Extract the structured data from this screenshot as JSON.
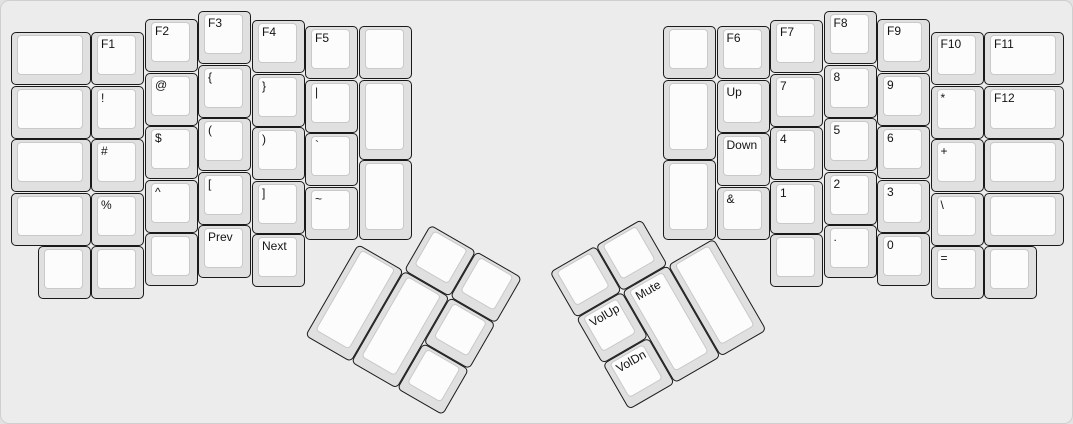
{
  "style": {
    "canvas_bg": "#ececec",
    "canvas_border": "#cfcfcf",
    "cap_color": "#e0e0e0",
    "cap_border": "#1a1a1a",
    "face_color": "#fcfcfc",
    "face_border": "#c9c9c9",
    "label_color": "#141414"
  },
  "left_main": {
    "name": "left-hand-block",
    "rotation_deg": 0,
    "origin_x": 0,
    "origin_y": 0,
    "keys": [
      {
        "label": "",
        "name": "blank",
        "x": 10,
        "y": 31,
        "w": 80,
        "h": 53
      },
      {
        "label": "F1",
        "name": "f1",
        "x": 90,
        "y": 31,
        "w": 53,
        "h": 53
      },
      {
        "label": "F2",
        "name": "f2",
        "x": 144,
        "y": 18,
        "w": 53,
        "h": 53
      },
      {
        "label": "F3",
        "name": "f3",
        "x": 197,
        "y": 10,
        "w": 53,
        "h": 53
      },
      {
        "label": "F4",
        "name": "f4",
        "x": 251,
        "y": 19,
        "w": 53,
        "h": 53
      },
      {
        "label": "F5",
        "name": "f5",
        "x": 304,
        "y": 25,
        "w": 53,
        "h": 53
      },
      {
        "label": "",
        "name": "blank",
        "x": 358,
        "y": 25,
        "w": 53,
        "h": 53
      },
      {
        "label": "",
        "name": "blank",
        "x": 10,
        "y": 84.5,
        "w": 80,
        "h": 53
      },
      {
        "label": "!",
        "name": "exclamation",
        "x": 90,
        "y": 84.5,
        "w": 53,
        "h": 53
      },
      {
        "label": "@",
        "name": "at",
        "x": 144,
        "y": 71.5,
        "w": 53,
        "h": 53
      },
      {
        "label": "{",
        "name": "left-brace",
        "x": 197,
        "y": 63.5,
        "w": 53,
        "h": 53
      },
      {
        "label": "}",
        "name": "right-brace",
        "x": 251,
        "y": 72.5,
        "w": 53,
        "h": 53
      },
      {
        "label": "|",
        "name": "pipe",
        "x": 304,
        "y": 78.5,
        "w": 53,
        "h": 53
      },
      {
        "label": "",
        "name": "blank-tall",
        "x": 358,
        "y": 78.5,
        "w": 53,
        "h": 80
      },
      {
        "label": "",
        "name": "blank",
        "x": 10,
        "y": 138,
        "w": 80,
        "h": 53
      },
      {
        "label": "#",
        "name": "hash",
        "x": 90,
        "y": 138,
        "w": 53,
        "h": 53
      },
      {
        "label": "$",
        "name": "dollar",
        "x": 144,
        "y": 125,
        "w": 53,
        "h": 53
      },
      {
        "label": "(",
        "name": "left-paren",
        "x": 197,
        "y": 117,
        "w": 53,
        "h": 53
      },
      {
        "label": ")",
        "name": "right-paren",
        "x": 251,
        "y": 126,
        "w": 53,
        "h": 53
      },
      {
        "label": "`",
        "name": "backtick",
        "x": 304,
        "y": 132,
        "w": 53,
        "h": 53
      },
      {
        "label": "",
        "name": "blank-tall",
        "x": 358,
        "y": 158.5,
        "w": 53,
        "h": 80
      },
      {
        "label": "",
        "name": "blank",
        "x": 10,
        "y": 191.5,
        "w": 80,
        "h": 53
      },
      {
        "label": "%",
        "name": "percent",
        "x": 90,
        "y": 191.5,
        "w": 53,
        "h": 53
      },
      {
        "label": "^",
        "name": "caret",
        "x": 144,
        "y": 178.5,
        "w": 53,
        "h": 53
      },
      {
        "label": "[",
        "name": "left-bracket",
        "x": 197,
        "y": 170.5,
        "w": 53,
        "h": 53
      },
      {
        "label": "]",
        "name": "right-bracket",
        "x": 251,
        "y": 179.5,
        "w": 53,
        "h": 53
      },
      {
        "label": "~",
        "name": "tilde",
        "x": 304,
        "y": 185.5,
        "w": 53,
        "h": 53
      },
      {
        "label": "",
        "name": "blank",
        "x": 37,
        "y": 245,
        "w": 53,
        "h": 53
      },
      {
        "label": "",
        "name": "blank",
        "x": 90,
        "y": 245,
        "w": 53,
        "h": 53
      },
      {
        "label": "",
        "name": "blank",
        "x": 144,
        "y": 232,
        "w": 53,
        "h": 53
      },
      {
        "label": "Prev",
        "name": "prev",
        "x": 197,
        "y": 224,
        "w": 53,
        "h": 53
      },
      {
        "label": "Next",
        "name": "next",
        "x": 251,
        "y": 233,
        "w": 53,
        "h": 53
      }
    ]
  },
  "right_main": {
    "name": "right-hand-block",
    "rotation_deg": 0,
    "origin_x": 0,
    "origin_y": 0,
    "keys": [
      {
        "label": "",
        "name": "blank",
        "x": 662,
        "y": 25,
        "w": 53,
        "h": 53
      },
      {
        "label": "F6",
        "name": "f6",
        "x": 715.5,
        "y": 25,
        "w": 53,
        "h": 53
      },
      {
        "label": "F7",
        "name": "f7",
        "x": 769,
        "y": 19,
        "w": 53,
        "h": 53
      },
      {
        "label": "F8",
        "name": "f8",
        "x": 822.5,
        "y": 10,
        "w": 53,
        "h": 53
      },
      {
        "label": "F9",
        "name": "f9",
        "x": 876,
        "y": 18,
        "w": 53,
        "h": 53
      },
      {
        "label": "F10",
        "name": "f10",
        "x": 929.5,
        "y": 31,
        "w": 53,
        "h": 53
      },
      {
        "label": "F11",
        "name": "f11",
        "x": 983,
        "y": 31,
        "w": 80,
        "h": 53
      },
      {
        "label": "",
        "name": "blank-tall",
        "x": 662,
        "y": 78.5,
        "w": 53,
        "h": 80
      },
      {
        "label": "Up",
        "name": "up",
        "x": 715.5,
        "y": 78.5,
        "w": 53,
        "h": 53
      },
      {
        "label": "7",
        "name": "7",
        "x": 769,
        "y": 72.5,
        "w": 53,
        "h": 53
      },
      {
        "label": "8",
        "name": "8",
        "x": 822.5,
        "y": 63.5,
        "w": 53,
        "h": 53
      },
      {
        "label": "9",
        "name": "9",
        "x": 876,
        "y": 71.5,
        "w": 53,
        "h": 53
      },
      {
        "label": "*",
        "name": "asterisk",
        "x": 929.5,
        "y": 84.5,
        "w": 53,
        "h": 53
      },
      {
        "label": "F12",
        "name": "f12",
        "x": 983,
        "y": 84.5,
        "w": 80,
        "h": 53
      },
      {
        "label": "",
        "name": "blank-tall",
        "x": 662,
        "y": 158.5,
        "w": 53,
        "h": 80
      },
      {
        "label": "Down",
        "name": "down",
        "x": 715.5,
        "y": 132,
        "w": 53,
        "h": 53
      },
      {
        "label": "4",
        "name": "4",
        "x": 769,
        "y": 126,
        "w": 53,
        "h": 53
      },
      {
        "label": "5",
        "name": "5",
        "x": 822.5,
        "y": 117,
        "w": 53,
        "h": 53
      },
      {
        "label": "6",
        "name": "6",
        "x": 876,
        "y": 125,
        "w": 53,
        "h": 53
      },
      {
        "label": "+",
        "name": "plus",
        "x": 929.5,
        "y": 138,
        "w": 53,
        "h": 53
      },
      {
        "label": "",
        "name": "blank",
        "x": 983,
        "y": 138,
        "w": 80,
        "h": 53
      },
      {
        "label": "&",
        "name": "ampersand",
        "x": 715.5,
        "y": 185.5,
        "w": 53,
        "h": 53
      },
      {
        "label": "1",
        "name": "1",
        "x": 769,
        "y": 179.5,
        "w": 53,
        "h": 53
      },
      {
        "label": "2",
        "name": "2",
        "x": 822.5,
        "y": 170.5,
        "w": 53,
        "h": 53
      },
      {
        "label": "3",
        "name": "3",
        "x": 876,
        "y": 178.5,
        "w": 53,
        "h": 53
      },
      {
        "label": "\\",
        "name": "backslash",
        "x": 929.5,
        "y": 191.5,
        "w": 53,
        "h": 53
      },
      {
        "label": "",
        "name": "blank",
        "x": 983,
        "y": 191.5,
        "w": 80,
        "h": 53
      },
      {
        "label": "",
        "name": "blank",
        "x": 769,
        "y": 233,
        "w": 53,
        "h": 53
      },
      {
        "label": ".",
        "name": "period",
        "x": 822.5,
        "y": 224,
        "w": 53,
        "h": 53
      },
      {
        "label": "0",
        "name": "0",
        "x": 876,
        "y": 232,
        "w": 53,
        "h": 53
      },
      {
        "label": "=",
        "name": "equals",
        "x": 929.5,
        "y": 245,
        "w": 53,
        "h": 53
      },
      {
        "label": "",
        "name": "blank",
        "x": 983,
        "y": 245,
        "w": 53,
        "h": 53
      }
    ]
  },
  "left_thumb": {
    "name": "left-thumb-cluster",
    "rotation_deg": 30,
    "origin_x": 357,
    "origin_y": 243,
    "keys": [
      {
        "label": "",
        "name": "blank",
        "x": 53,
        "y": -53,
        "w": 53,
        "h": 53
      },
      {
        "label": "",
        "name": "blank",
        "x": 106,
        "y": -53,
        "w": 53,
        "h": 53
      },
      {
        "label": "",
        "name": "blank-tall",
        "x": 0,
        "y": 0,
        "w": 53,
        "h": 106
      },
      {
        "label": "",
        "name": "blank-tall",
        "x": 53,
        "y": 0,
        "w": 53,
        "h": 106
      },
      {
        "label": "",
        "name": "blank",
        "x": 106,
        "y": 0,
        "w": 53,
        "h": 53
      },
      {
        "label": "",
        "name": "blank",
        "x": 106,
        "y": 53,
        "w": 53,
        "h": 53
      }
    ]
  },
  "right_thumb": {
    "name": "right-thumb-cluster",
    "rotation_deg": -30,
    "origin_x": 575,
    "origin_y": 317,
    "keys": [
      {
        "label": "",
        "name": "blank",
        "x": 0,
        "y": -53,
        "w": 53,
        "h": 53
      },
      {
        "label": "",
        "name": "blank",
        "x": 53,
        "y": -53,
        "w": 53,
        "h": 53
      },
      {
        "label": "VolUp",
        "name": "vol-up",
        "x": 0,
        "y": 0,
        "w": 53,
        "h": 53
      },
      {
        "label": "Mute",
        "name": "mute",
        "x": 53,
        "y": 0,
        "w": 53,
        "h": 106
      },
      {
        "label": "",
        "name": "blank-tall",
        "x": 106,
        "y": 0,
        "w": 53,
        "h": 106
      },
      {
        "label": "VolDn",
        "name": "vol-dn",
        "x": 0,
        "y": 53,
        "w": 53,
        "h": 53
      }
    ]
  }
}
